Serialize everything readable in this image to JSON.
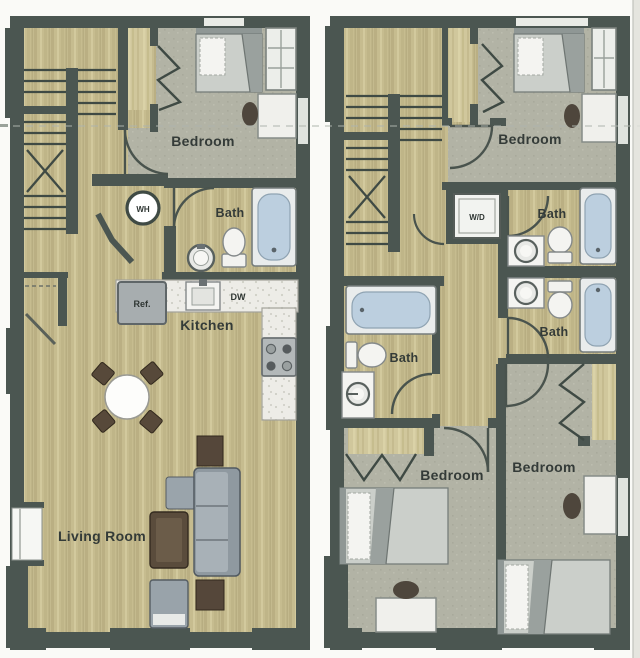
{
  "page": {
    "background": "#fafaf7",
    "description": "Scanned two-unit townhouse floor plans, side by side"
  },
  "left_unit": {
    "rooms": {
      "bedroom": "Bedroom",
      "bath": "Bath",
      "kitchen": "Kitchen",
      "living_room": "Living Room"
    },
    "fixtures": {
      "water_heater": "WH",
      "refrigerator": "Ref.",
      "dishwasher": "DW"
    }
  },
  "right_unit": {
    "rooms": {
      "bedroom_top": "Bedroom",
      "bath_top": "Bath",
      "bath_mid": "Bath",
      "bath_left": "Bath",
      "bedroom_left": "Bedroom",
      "bedroom_right": "Bedroom"
    },
    "fixtures": {
      "washer_dryer": "W/D"
    }
  },
  "colors": {
    "wall": "#4b5651",
    "wall_line": "#3f4a44",
    "wood": "#c6bc8f",
    "carpet": "#b2b3a5",
    "counter": "#edece7",
    "tub_water": "#bccfdf",
    "fixture_white": "#f3f3ef",
    "appliance_gray": "#a2a8aa",
    "sofa_gray": "#959fa6",
    "dark_wood_furniture": "#57493a",
    "label_text": "#343b38"
  }
}
